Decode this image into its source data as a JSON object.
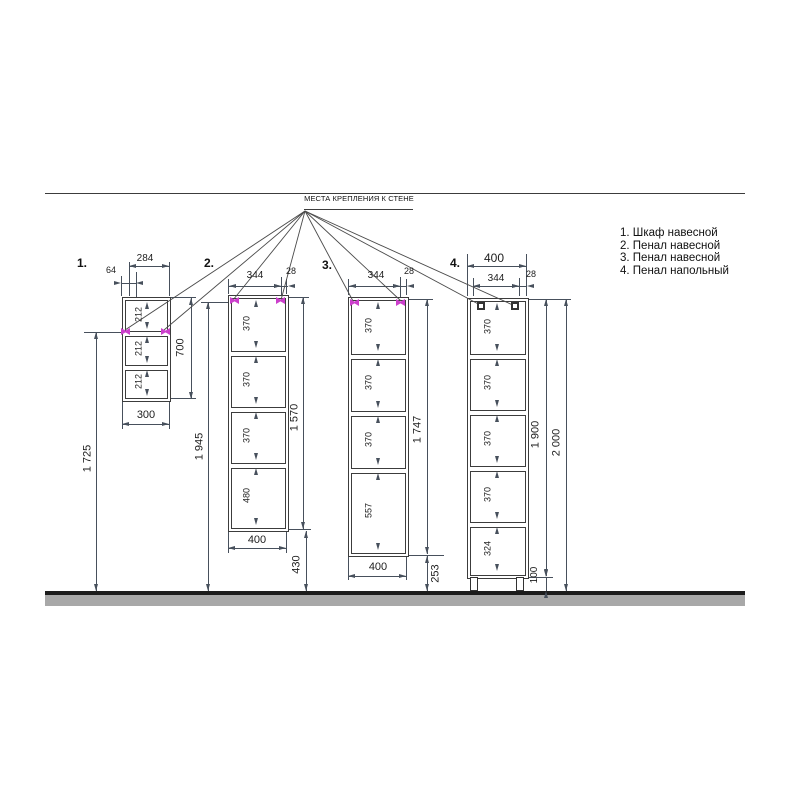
{
  "title": "МЕСТА КРЕПЛЕНИЯ К СТЕНЕ",
  "legend": {
    "items": [
      {
        "label": "1. Шкаф навесной"
      },
      {
        "label": "2. Пенал навесной"
      },
      {
        "label": "3. Пенал навесной"
      },
      {
        "label": "4. Пенал напольный"
      }
    ]
  },
  "cabinets": [
    {
      "index_label": "1.",
      "name": "Шкаф навесной",
      "top_width": "284",
      "mount_offset": "64",
      "sections": [
        "212",
        "212",
        "212"
      ],
      "height": "700",
      "bottom_width": "300",
      "mount_height_from_floor": "1 725"
    },
    {
      "index_label": "2.",
      "name": "Пенал навесной",
      "mount_span": "344",
      "mount_edge_offset": "28",
      "sections": [
        "370",
        "370",
        "370",
        "480"
      ],
      "height": "1 570",
      "bottom_width": "400",
      "floor_gap": "430",
      "mount_height_from_floor": "1 945"
    },
    {
      "index_label": "3.",
      "name": "Пенал навесной",
      "mount_span": "344",
      "mount_edge_offset": "28",
      "sections": [
        "370",
        "370",
        "370",
        "557"
      ],
      "height": "1 747",
      "bottom_width": "400",
      "floor_gap": "253"
    },
    {
      "index_label": "4.",
      "name": "Пенал напольный",
      "top_width": "400",
      "mount_span": "344",
      "mount_edge_offset": "28",
      "sections": [
        "370",
        "370",
        "370",
        "370",
        "324"
      ],
      "height": "1 900",
      "leg_height": "100",
      "total_height": "2 000"
    }
  ],
  "colors": {
    "drawing_line": "#3c3c3c",
    "dimension_line": "#47505c",
    "mount_mark": "#cc3fcc",
    "floor_line": "#1c1c1c",
    "floor_band": "#a8a8a8"
  }
}
